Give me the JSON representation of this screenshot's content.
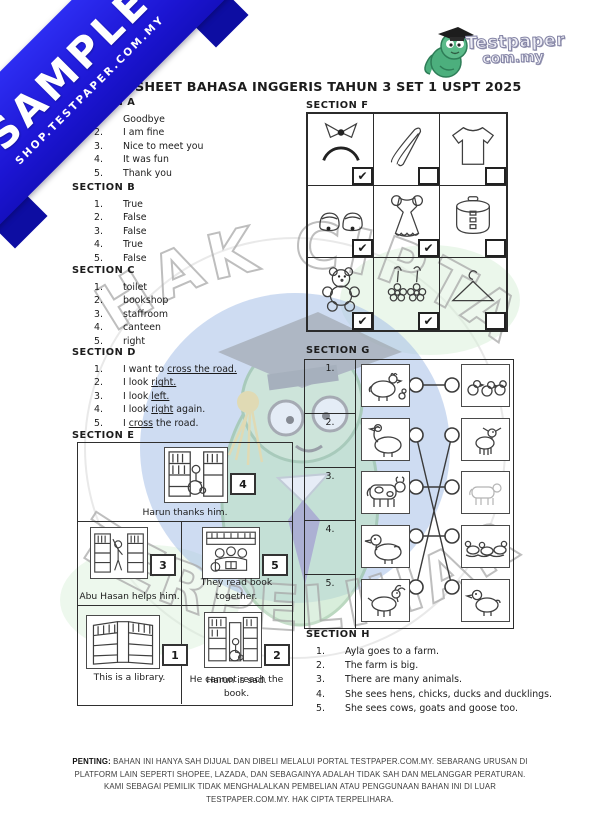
{
  "ribbon": {
    "label": "SAMPLE",
    "sublabel": "SHOP.TESTPAPER.COM.MY"
  },
  "logo": {
    "line1": "Testpaper",
    "line2": "com.my"
  },
  "title": "ANSWER SHEET BAHASA INGGERIS TAHUN 3 SET 1 USPT 2025",
  "watermark": {
    "top": "HAK CIPTA",
    "bottom": "TERPELIHARA"
  },
  "sections": {
    "a": {
      "heading": "SECTION A",
      "numbers": [
        "1.",
        "2.",
        "3.",
        "4.",
        "5."
      ],
      "items": [
        "Goodbye",
        "I am fine",
        "Nice to meet you",
        "It was fun",
        "Thank you"
      ]
    },
    "b": {
      "heading": "SECTION B",
      "numbers": [
        "1.",
        "2.",
        "3.",
        "4.",
        "5."
      ],
      "items": [
        "True",
        "False",
        "False",
        "True",
        "False"
      ]
    },
    "c": {
      "heading": "SECTION C",
      "numbers": [
        "1.",
        "2.",
        "3.",
        "4.",
        "5."
      ],
      "items": [
        "toilet",
        "bookshop",
        "staffroom",
        "canteen",
        "right"
      ]
    },
    "d": {
      "heading": "SECTION D",
      "numbers": [
        "1.",
        "2.",
        "3.",
        "4.",
        "5."
      ],
      "items": [
        {
          "pre": "I want to ",
          "u": "cross the road.",
          "post": ""
        },
        {
          "pre": "I look ",
          "u": "right.",
          "post": ""
        },
        {
          "pre": "I look ",
          "u": "left.",
          "post": ""
        },
        {
          "pre": "I look ",
          "u": "right",
          "post": " again."
        },
        {
          "pre": "I ",
          "u": "cross",
          "post": " the road."
        }
      ]
    },
    "e": {
      "heading": "SECTION E",
      "cards": [
        {
          "answer": "4",
          "caption": "Harun thanks him."
        },
        {
          "answer": "3",
          "caption": "Abu Hasan helps him."
        },
        {
          "answer": "5",
          "caption": "They read book together."
        },
        {
          "answer": "1",
          "caption": "This is a library."
        },
        {
          "answer": "2",
          "caption": "Harun is sad.",
          "caption2": "He cannot reach the book."
        }
      ]
    },
    "f": {
      "heading": "SECTION F",
      "cells": [
        {
          "item": "headband",
          "check": "✔"
        },
        {
          "item": "tongs",
          "check": ""
        },
        {
          "item": "t-shirt",
          "check": ""
        },
        {
          "item": "shoes",
          "check": "✔"
        },
        {
          "item": "dress",
          "check": "✔"
        },
        {
          "item": "rice-cooker",
          "check": ""
        },
        {
          "item": "teddy-bear",
          "check": "✔"
        },
        {
          "item": "earrings",
          "check": "✔"
        },
        {
          "item": "hanger",
          "check": ""
        }
      ]
    },
    "g": {
      "heading": "SECTION G",
      "numbers": [
        "1.",
        "2.",
        "3.",
        "4.",
        "5."
      ],
      "left_items": [
        "hen",
        "goose",
        "cow",
        "duck",
        "goat"
      ],
      "right_items": [
        "chicks",
        "kid-goat",
        "calf",
        "ducklings",
        "gosling"
      ],
      "matches": [
        [
          1,
          1
        ],
        [
          2,
          5
        ],
        [
          3,
          3
        ],
        [
          4,
          4
        ],
        [
          5,
          2
        ]
      ]
    },
    "h": {
      "heading": "SECTION H",
      "numbers": [
        "1.",
        "2.",
        "3.",
        "4.",
        "5."
      ],
      "items": [
        "Ayla goes to a farm.",
        "The farm is big.",
        "There are many animals.",
        "She sees hens, chicks, ducks and ducklings.",
        "She sees cows, goats and goose too."
      ]
    }
  },
  "footer": {
    "label": "PENTING:",
    "text": " BAHAN INI HANYA SAH DIJUAL DAN DIBELI MELALUI PORTAL TESTPAPER.COM.MY. SEBARANG URUSAN DI PLATFORM LAIN SEPERTI SHOPEE, LAZADA, DAN SEBAGAINYA ADALAH TIDAK SAH DAN MELANGGAR PERATURAN. KAMI SEBAGAI PEMILIK TIDAK MENGHALALKAN PEMBELIAN ATAU PENGGUNAAN BAHAN INI DI LUAR TESTPAPER.COM.MY. HAK CIPTA TERPELIHARA."
  },
  "colors": {
    "ribbon_blue": "#1c15d2",
    "watermark_blue": "#a6c0e8",
    "mascot_green": "#bfe3c4",
    "accent_dark": "#2b2b2b"
  }
}
